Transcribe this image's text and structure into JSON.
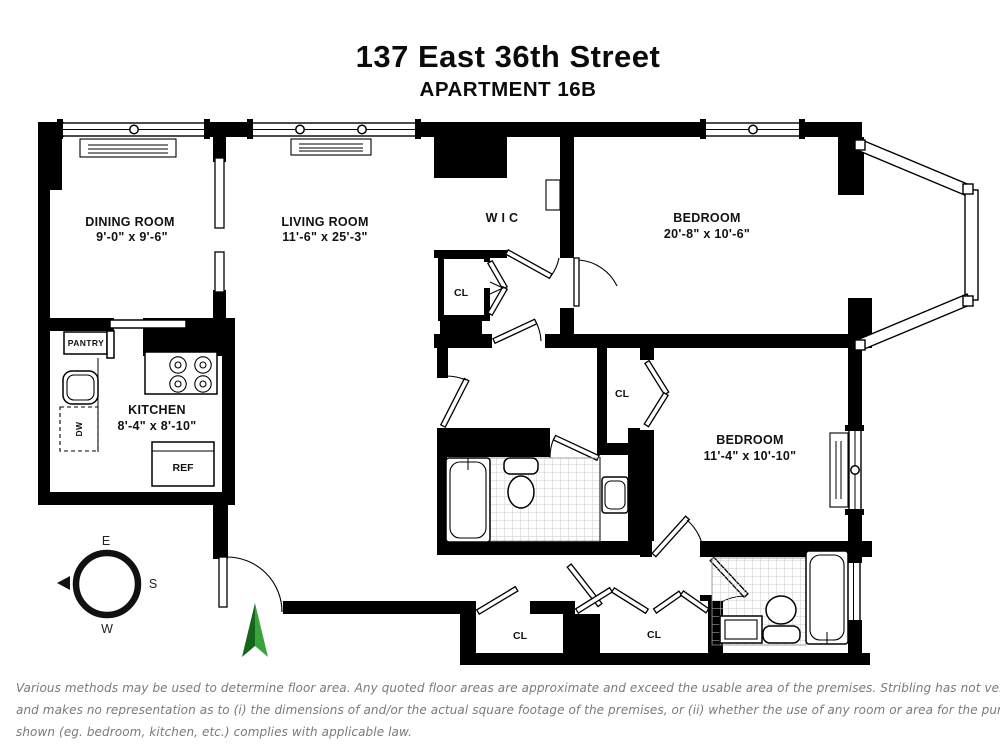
{
  "header": {
    "title": "137 East 36th Street",
    "subtitle": "APARTMENT 16B"
  },
  "rooms": {
    "dining": {
      "name": "DINING ROOM",
      "dims": "9'-0\" x 9'-6\""
    },
    "living": {
      "name": "LIVING ROOM",
      "dims": "11'-6\" x 25'-3\""
    },
    "kitchen": {
      "name": "KITCHEN",
      "dims": "8'-4\" x 8'-10\""
    },
    "bedroom1": {
      "name": "BEDROOM",
      "dims": "20'-8\" x 10'-6\""
    },
    "bedroom2": {
      "name": "BEDROOM",
      "dims": "11'-4\" x 10'-10\""
    },
    "wic": {
      "name": "W I C"
    }
  },
  "labels": {
    "closet": "CL",
    "pantry": "PANTRY",
    "refrigerator": "REF",
    "dishwasher": "DW"
  },
  "compass": {
    "east": "E",
    "south": "S",
    "west": "W"
  },
  "colors": {
    "wall": "#000000",
    "north_arrow_dark": "#15661a",
    "north_arrow_light": "#3aa43c",
    "tile_line": "#8a8a8a",
    "disclaimer_text": "#7a7a7a"
  },
  "disclaimer": {
    "line1": "Various methods may be used to determine floor area. Any quoted floor areas are approximate and exceed the usable area of the premises. Stribling has not verified",
    "line2": "and makes no representation as to (i) the dimensions of and/or the actual square footage of the premises, or (ii) whether the use of any room or area for the purpose",
    "line3": "shown (eg. bedroom, kitchen, etc.) complies with applicable law."
  }
}
